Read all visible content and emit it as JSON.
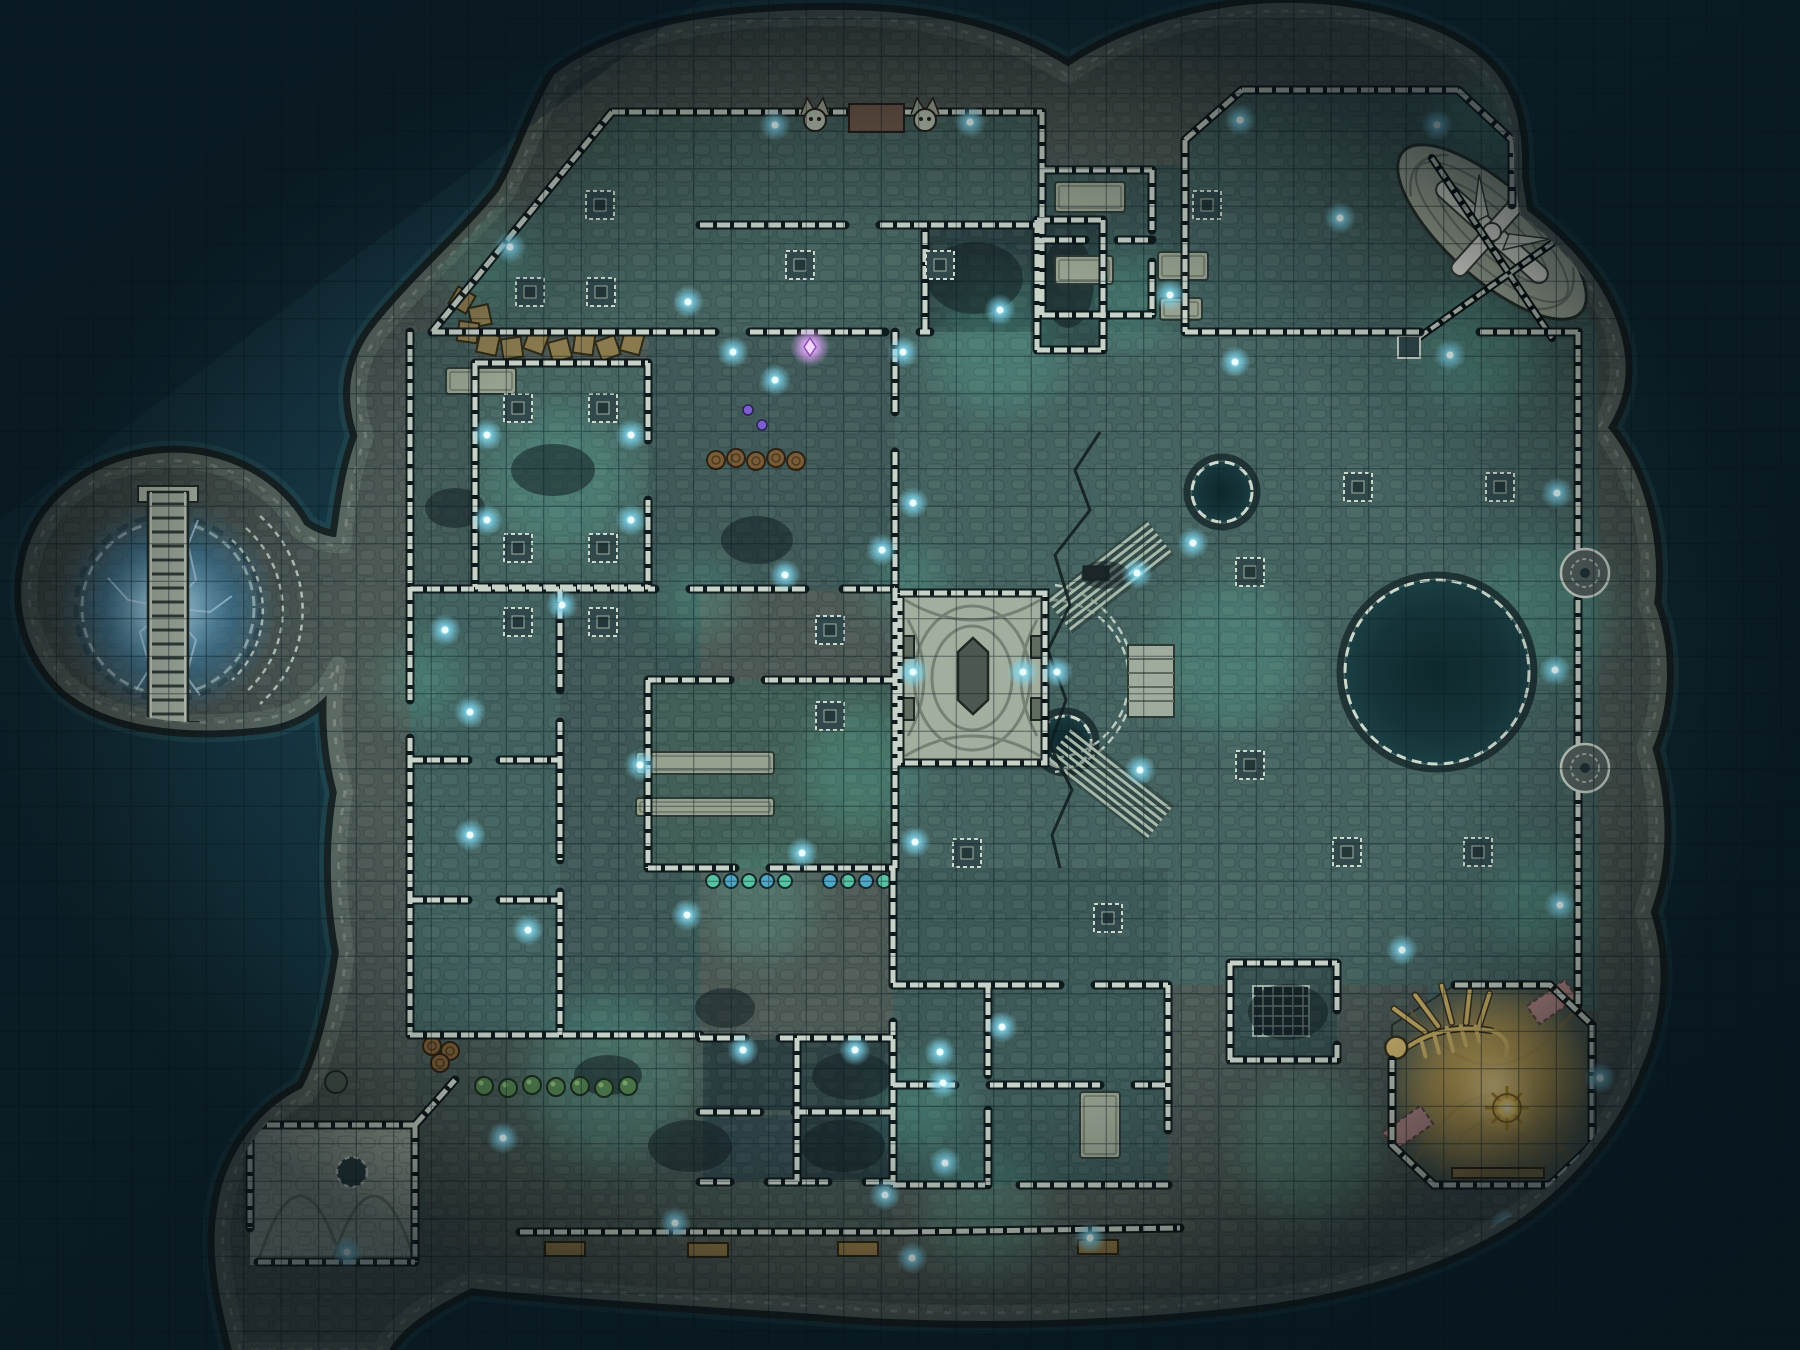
{
  "scene": {
    "kind": "fantasy-battle-map",
    "description": "sunken-temple-island-night",
    "grid": {
      "size": 37.5,
      "offset_x": 18.75,
      "offset_y": 18.75,
      "cols": 48,
      "rows": 36,
      "color": "rgba(8,28,36,0.5)"
    }
  },
  "palette": {
    "water_deep": "#0f2833",
    "water_mid": "#153541",
    "water_light": "#1c4050",
    "rock_dark": "#1a2526",
    "rock_mid": "#5e6c65",
    "ground": "#4d5955",
    "wall_light": "#c7d3c9",
    "wall_dark": "#0b1517",
    "floor_teal": "#456360",
    "floor_dark": "#2c4143",
    "stone_light": "#a2af9f",
    "glow_blue": "#7fd9f2",
    "glow_purple": "#e2a6ff",
    "glow_teal": "#63d6b8",
    "gold": "#c9a85c",
    "gold_glow": "#ffd978",
    "pool": "#153439",
    "bush_green": "#4e7b4d",
    "barrel_brown": "#7a5c38"
  },
  "lights": {
    "blue": [
      [
        775,
        125
      ],
      [
        970,
        122
      ],
      [
        1240,
        120
      ],
      [
        1437,
        125
      ],
      [
        1340,
        218
      ],
      [
        510,
        247
      ],
      [
        688,
        302
      ],
      [
        445,
        630
      ],
      [
        487,
        435
      ],
      [
        631,
        435
      ],
      [
        487,
        520
      ],
      [
        631,
        520
      ],
      [
        562,
        605
      ],
      [
        775,
        380
      ],
      [
        785,
        575
      ],
      [
        733,
        352
      ],
      [
        903,
        352
      ],
      [
        1000,
        310
      ],
      [
        1170,
        295
      ],
      [
        913,
        503
      ],
      [
        882,
        550
      ],
      [
        913,
        672
      ],
      [
        1023,
        672
      ],
      [
        1057,
        672
      ],
      [
        1137,
        573
      ],
      [
        1140,
        770
      ],
      [
        1235,
        362
      ],
      [
        1450,
        355
      ],
      [
        1193,
        543
      ],
      [
        1557,
        493
      ],
      [
        1555,
        670
      ],
      [
        1560,
        905
      ],
      [
        1600,
        1078
      ],
      [
        915,
        842
      ],
      [
        802,
        853
      ],
      [
        687,
        915
      ],
      [
        743,
        1050
      ],
      [
        855,
        1050
      ],
      [
        940,
        1052
      ],
      [
        1002,
        1027
      ],
      [
        943,
        1083
      ],
      [
        945,
        1163
      ],
      [
        885,
        1195
      ],
      [
        675,
        1223
      ],
      [
        912,
        1258
      ],
      [
        1090,
        1238
      ],
      [
        1402,
        950
      ],
      [
        1506,
        1225
      ],
      [
        470,
        712
      ],
      [
        470,
        835
      ],
      [
        528,
        930
      ],
      [
        640,
        765
      ],
      [
        503,
        1138
      ],
      [
        347,
        1252
      ]
    ],
    "purple": [
      [
        810,
        347
      ]
    ]
  },
  "pillar_bases": [
    [
      600,
      205
    ],
    [
      530,
      292
    ],
    [
      601,
      292
    ],
    [
      800,
      265
    ],
    [
      940,
      265
    ],
    [
      518,
      408
    ],
    [
      603,
      408
    ],
    [
      518,
      548
    ],
    [
      603,
      548
    ],
    [
      518,
      622
    ],
    [
      603,
      622
    ],
    [
      830,
      630
    ],
    [
      830,
      716
    ],
    [
      1358,
      487
    ],
    [
      1500,
      487
    ],
    [
      1250,
      572
    ],
    [
      1250,
      765
    ],
    [
      1347,
      852
    ],
    [
      1478,
      852
    ],
    [
      1528,
      157
    ],
    [
      1207,
      205
    ],
    [
      967,
      853
    ],
    [
      1108,
      918
    ]
  ],
  "wall_rosettes": [
    [
      1585,
      573
    ],
    [
      1585,
      768
    ]
  ],
  "bushes": [
    [
      484,
      1086
    ],
    [
      508,
      1088
    ],
    [
      532,
      1085
    ],
    [
      556,
      1087
    ],
    [
      580,
      1086
    ],
    [
      604,
      1088
    ],
    [
      628,
      1086
    ]
  ],
  "flowers": [
    [
      748,
      410
    ],
    [
      762,
      425
    ]
  ],
  "beads": [
    [
      713,
      881
    ],
    [
      731,
      881
    ],
    [
      749,
      881
    ],
    [
      767,
      881
    ],
    [
      785,
      881
    ],
    [
      830,
      881
    ],
    [
      848,
      881
    ],
    [
      866,
      881
    ],
    [
      884,
      881
    ]
  ],
  "barrels": [
    [
      716,
      460
    ],
    [
      736,
      458
    ],
    [
      756,
      461
    ],
    [
      776,
      458
    ],
    [
      796,
      461
    ],
    [
      432,
      1046
    ],
    [
      450,
      1051
    ],
    [
      440,
      1063
    ]
  ],
  "crates": [
    [
      488,
      344,
      12
    ],
    [
      512,
      348,
      -8
    ],
    [
      536,
      342,
      20
    ],
    [
      560,
      350,
      -15
    ],
    [
      584,
      344,
      8
    ],
    [
      608,
      348,
      -20
    ],
    [
      632,
      343,
      15
    ],
    [
      462,
      300,
      30
    ],
    [
      480,
      316,
      -12
    ],
    [
      468,
      332,
      8
    ]
  ],
  "tables": [
    [
      1055,
      182,
      70,
      30
    ],
    [
      1055,
      256,
      58,
      28
    ],
    [
      1158,
      252,
      50,
      28
    ],
    [
      1160,
      298,
      42,
      22
    ],
    [
      636,
      752,
      138,
      22
    ],
    [
      636,
      798,
      138,
      18
    ],
    [
      446,
      368,
      70,
      26
    ],
    [
      1080,
      1092,
      40,
      66
    ]
  ],
  "gold_benches": [
    [
      545,
      1242
    ],
    [
      688,
      1243
    ],
    [
      838,
      1242
    ],
    [
      1078,
      1240
    ]
  ],
  "debris": [
    [
      975,
      278,
      48,
      36
    ],
    [
      1068,
      282,
      26,
      46
    ],
    [
      553,
      470,
      42,
      26
    ],
    [
      757,
      540,
      36,
      24
    ],
    [
      690,
      1146,
      42,
      26
    ],
    [
      843,
      1146,
      42,
      26
    ],
    [
      852,
      1076,
      40,
      24
    ],
    [
      1288,
      1012,
      40,
      28
    ],
    [
      455,
      508,
      30,
      20
    ],
    [
      725,
      1008,
      30,
      20
    ],
    [
      1105,
      575,
      24,
      14
    ],
    [
      608,
      1075,
      34,
      20
    ]
  ],
  "glow_patches": [
    [
      560,
      480,
      70
    ],
    [
      610,
      1080,
      80
    ],
    [
      860,
      770,
      60
    ],
    [
      1000,
      345,
      70
    ],
    [
      1230,
      655,
      75
    ],
    [
      1545,
      610,
      70
    ],
    [
      1310,
      1150,
      70
    ],
    [
      985,
      1215,
      60
    ],
    [
      760,
      905,
      55
    ],
    [
      1475,
      350,
      60
    ],
    [
      905,
      585,
      40
    ],
    [
      1130,
      300,
      50
    ],
    [
      480,
      250,
      50
    ],
    [
      700,
      600,
      40
    ],
    [
      1540,
      900,
      50
    ],
    [
      1480,
      120,
      40
    ],
    [
      920,
      1110,
      50
    ],
    [
      420,
      680,
      40
    ]
  ],
  "features": {
    "portal": {
      "cx": 168,
      "cy": 608
    },
    "pool": {
      "cx": 1437,
      "cy": 672,
      "r": 92
    },
    "ponds": [
      [
        1222,
        492,
        30
      ],
      [
        1065,
        742,
        26
      ]
    ],
    "altar": {
      "x": 900,
      "y": 593,
      "w": 145,
      "h": 170
    },
    "gold_vault": {
      "cx": 1496,
      "cy": 1085
    },
    "orb": {
      "cx": 1507,
      "cy": 1108
    },
    "ship": {
      "cx": 1492,
      "cy": 232,
      "angle": 42
    }
  }
}
